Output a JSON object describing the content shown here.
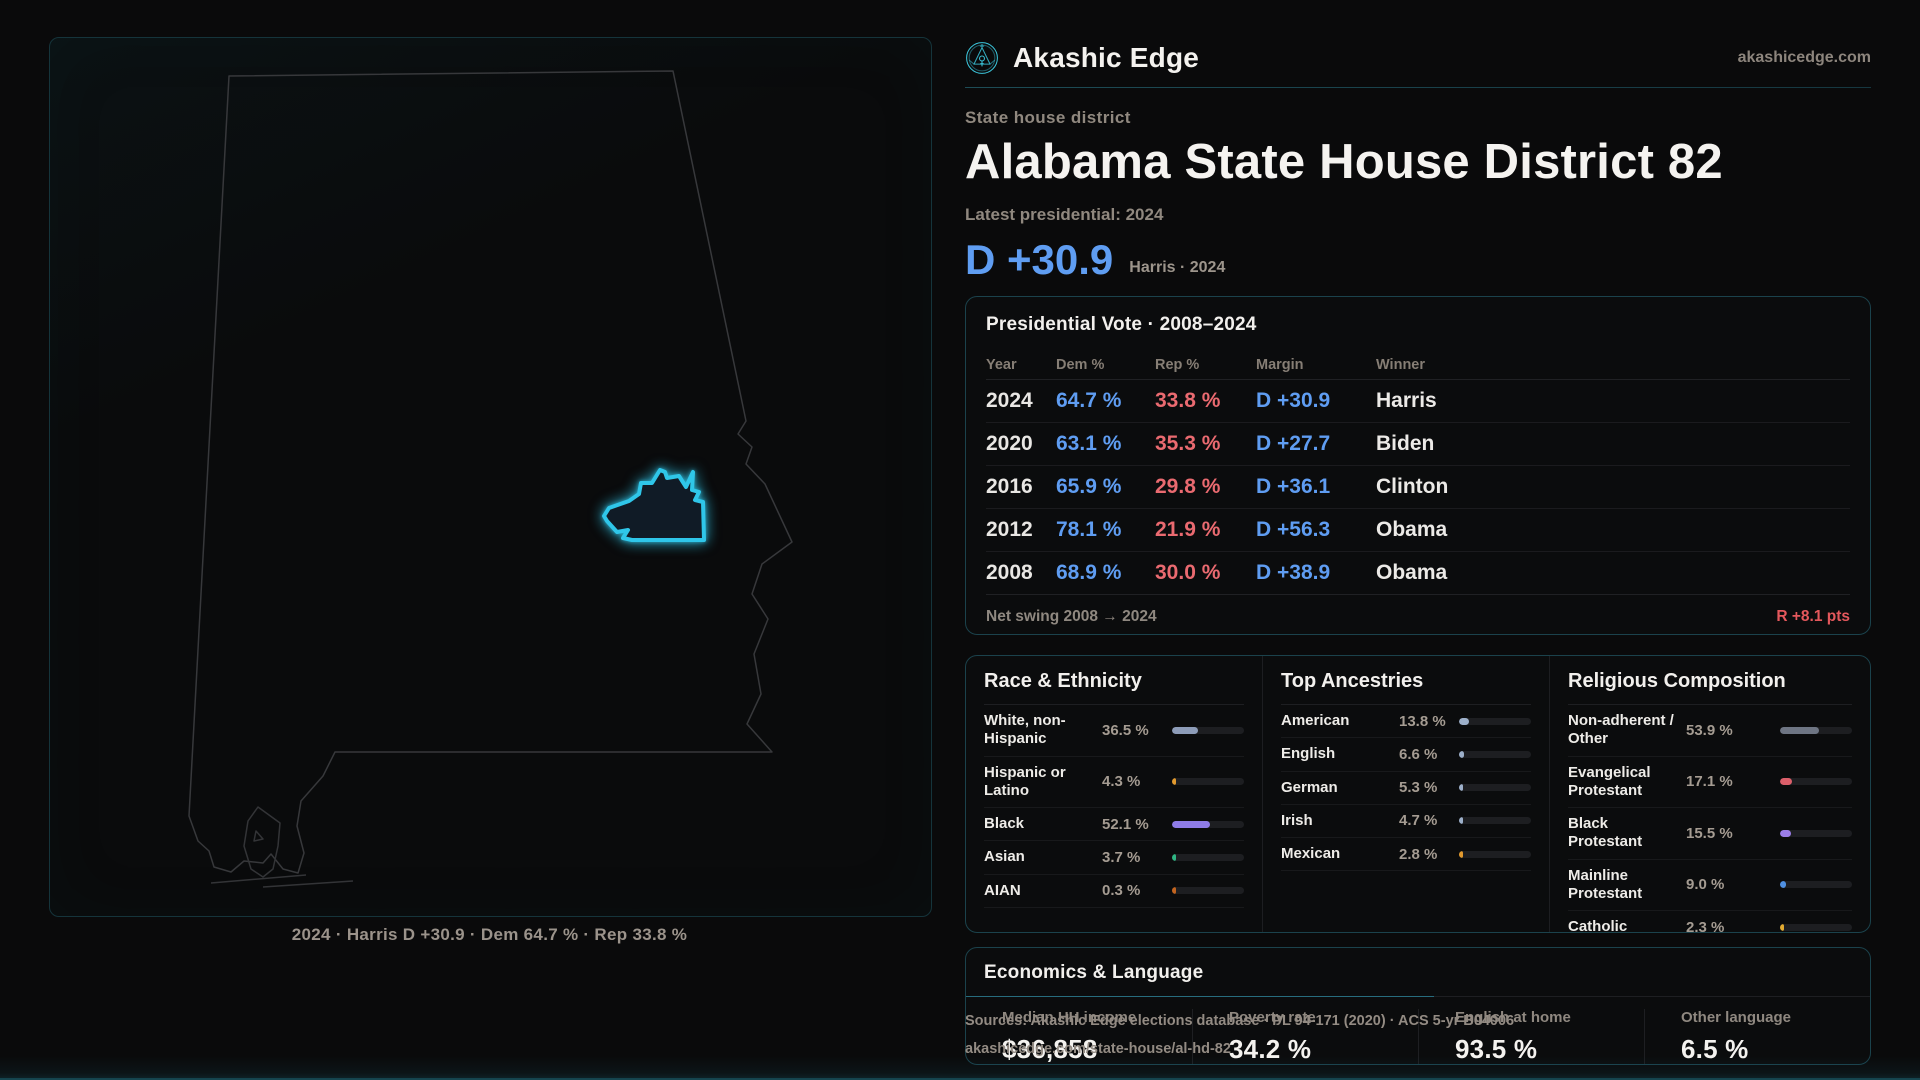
{
  "colors": {
    "accent": "#2fc6e9",
    "dem": "#5f9df2",
    "rep": "#ea6a70",
    "swing": "#e4585c",
    "bar_track": "#1d1e21"
  },
  "brand": {
    "name": "Akashic Edge",
    "domain": "akashicedge.com"
  },
  "header": {
    "kicker": "State house district",
    "title": "Alabama State House District 82",
    "subtitle": "Latest presidential: 2024",
    "margin": "D +30.9",
    "margin_context": "Harris · 2024"
  },
  "map": {
    "caption": "2024 · Harris D +30.9 · Dem 64.7 % · Rep 33.8 %"
  },
  "presidential": {
    "title": "Presidential Vote · 2008–2024",
    "columns": [
      "Year",
      "Dem %",
      "Rep %",
      "Margin",
      "Winner"
    ],
    "rows": [
      {
        "year": "2024",
        "dem": "64.7 %",
        "rep": "33.8 %",
        "margin": "D +30.9",
        "winner": "Harris"
      },
      {
        "year": "2020",
        "dem": "63.1 %",
        "rep": "35.3 %",
        "margin": "D +27.7",
        "winner": "Biden"
      },
      {
        "year": "2016",
        "dem": "65.9 %",
        "rep": "29.8 %",
        "margin": "D +36.1",
        "winner": "Clinton"
      },
      {
        "year": "2012",
        "dem": "78.1 %",
        "rep": "21.9 %",
        "margin": "D +56.3",
        "winner": "Obama"
      },
      {
        "year": "2008",
        "dem": "68.9 %",
        "rep": "30.0 %",
        "margin": "D +38.9",
        "winner": "Obama"
      }
    ],
    "net_swing_label": "Net swing 2008 → 2024",
    "net_swing_value": "R +8.1 pts"
  },
  "demographics": {
    "sections": [
      {
        "title": "Race & Ethnicity",
        "rows": [
          {
            "label": "White, non-Hispanic",
            "value": "36.5 %",
            "pct": 36.5,
            "color": "#8d9cb8"
          },
          {
            "label": "Hispanic or Latino",
            "value": "4.3 %",
            "pct": 4.3,
            "color": "#e29a2e"
          },
          {
            "label": "Black",
            "value": "52.1 %",
            "pct": 52.1,
            "color": "#8f7ce8"
          },
          {
            "label": "Asian",
            "value": "3.7 %",
            "pct": 3.7,
            "color": "#2fb583"
          },
          {
            "label": "AIAN",
            "value": "0.3 %",
            "pct": 0.3,
            "color": "#c2641f"
          }
        ]
      },
      {
        "title": "Top Ancestries",
        "rows": [
          {
            "label": "American",
            "value": "13.8 %",
            "pct": 13.8,
            "color": "#9db0ca"
          },
          {
            "label": "English",
            "value": "6.6 %",
            "pct": 6.6,
            "color": "#9db0ca"
          },
          {
            "label": "German",
            "value": "5.3 %",
            "pct": 5.3,
            "color": "#9db0ca"
          },
          {
            "label": "Irish",
            "value": "4.7 %",
            "pct": 4.7,
            "color": "#9db0ca"
          },
          {
            "label": "Mexican",
            "value": "2.8 %",
            "pct": 2.8,
            "color": "#e29a2e"
          }
        ]
      },
      {
        "title": "Religious Composition",
        "rows": [
          {
            "label": "Non-adherent / Other",
            "value": "53.9 %",
            "pct": 53.9,
            "color": "#6e7583"
          },
          {
            "label": "Evangelical Protestant",
            "value": "17.1 %",
            "pct": 17.1,
            "color": "#dc5f6a"
          },
          {
            "label": "Black Protestant",
            "value": "15.5 %",
            "pct": 15.5,
            "color": "#9b7de8"
          },
          {
            "label": "Mainline Protestant",
            "value": "9.0 %",
            "pct": 9.0,
            "color": "#4f90e2"
          },
          {
            "label": "Catholic",
            "value": "2.3 %",
            "pct": 2.3,
            "color": "#e2ab31"
          }
        ]
      }
    ]
  },
  "economics": {
    "title": "Economics & Language",
    "stats": [
      {
        "label": "Median HH income",
        "value": "$36,858"
      },
      {
        "label": "Poverty rate",
        "value": "34.2 %"
      },
      {
        "label": "English at home",
        "value": "93.5 %"
      },
      {
        "label": "Other language",
        "value": "6.5 %"
      }
    ]
  },
  "sources": {
    "line1": "Sources: Akashic Edge elections database · PL 94-171 (2020) · ACS 5-yr B04006",
    "line2": "akashicedge.com/state-house/al-hd-82"
  }
}
